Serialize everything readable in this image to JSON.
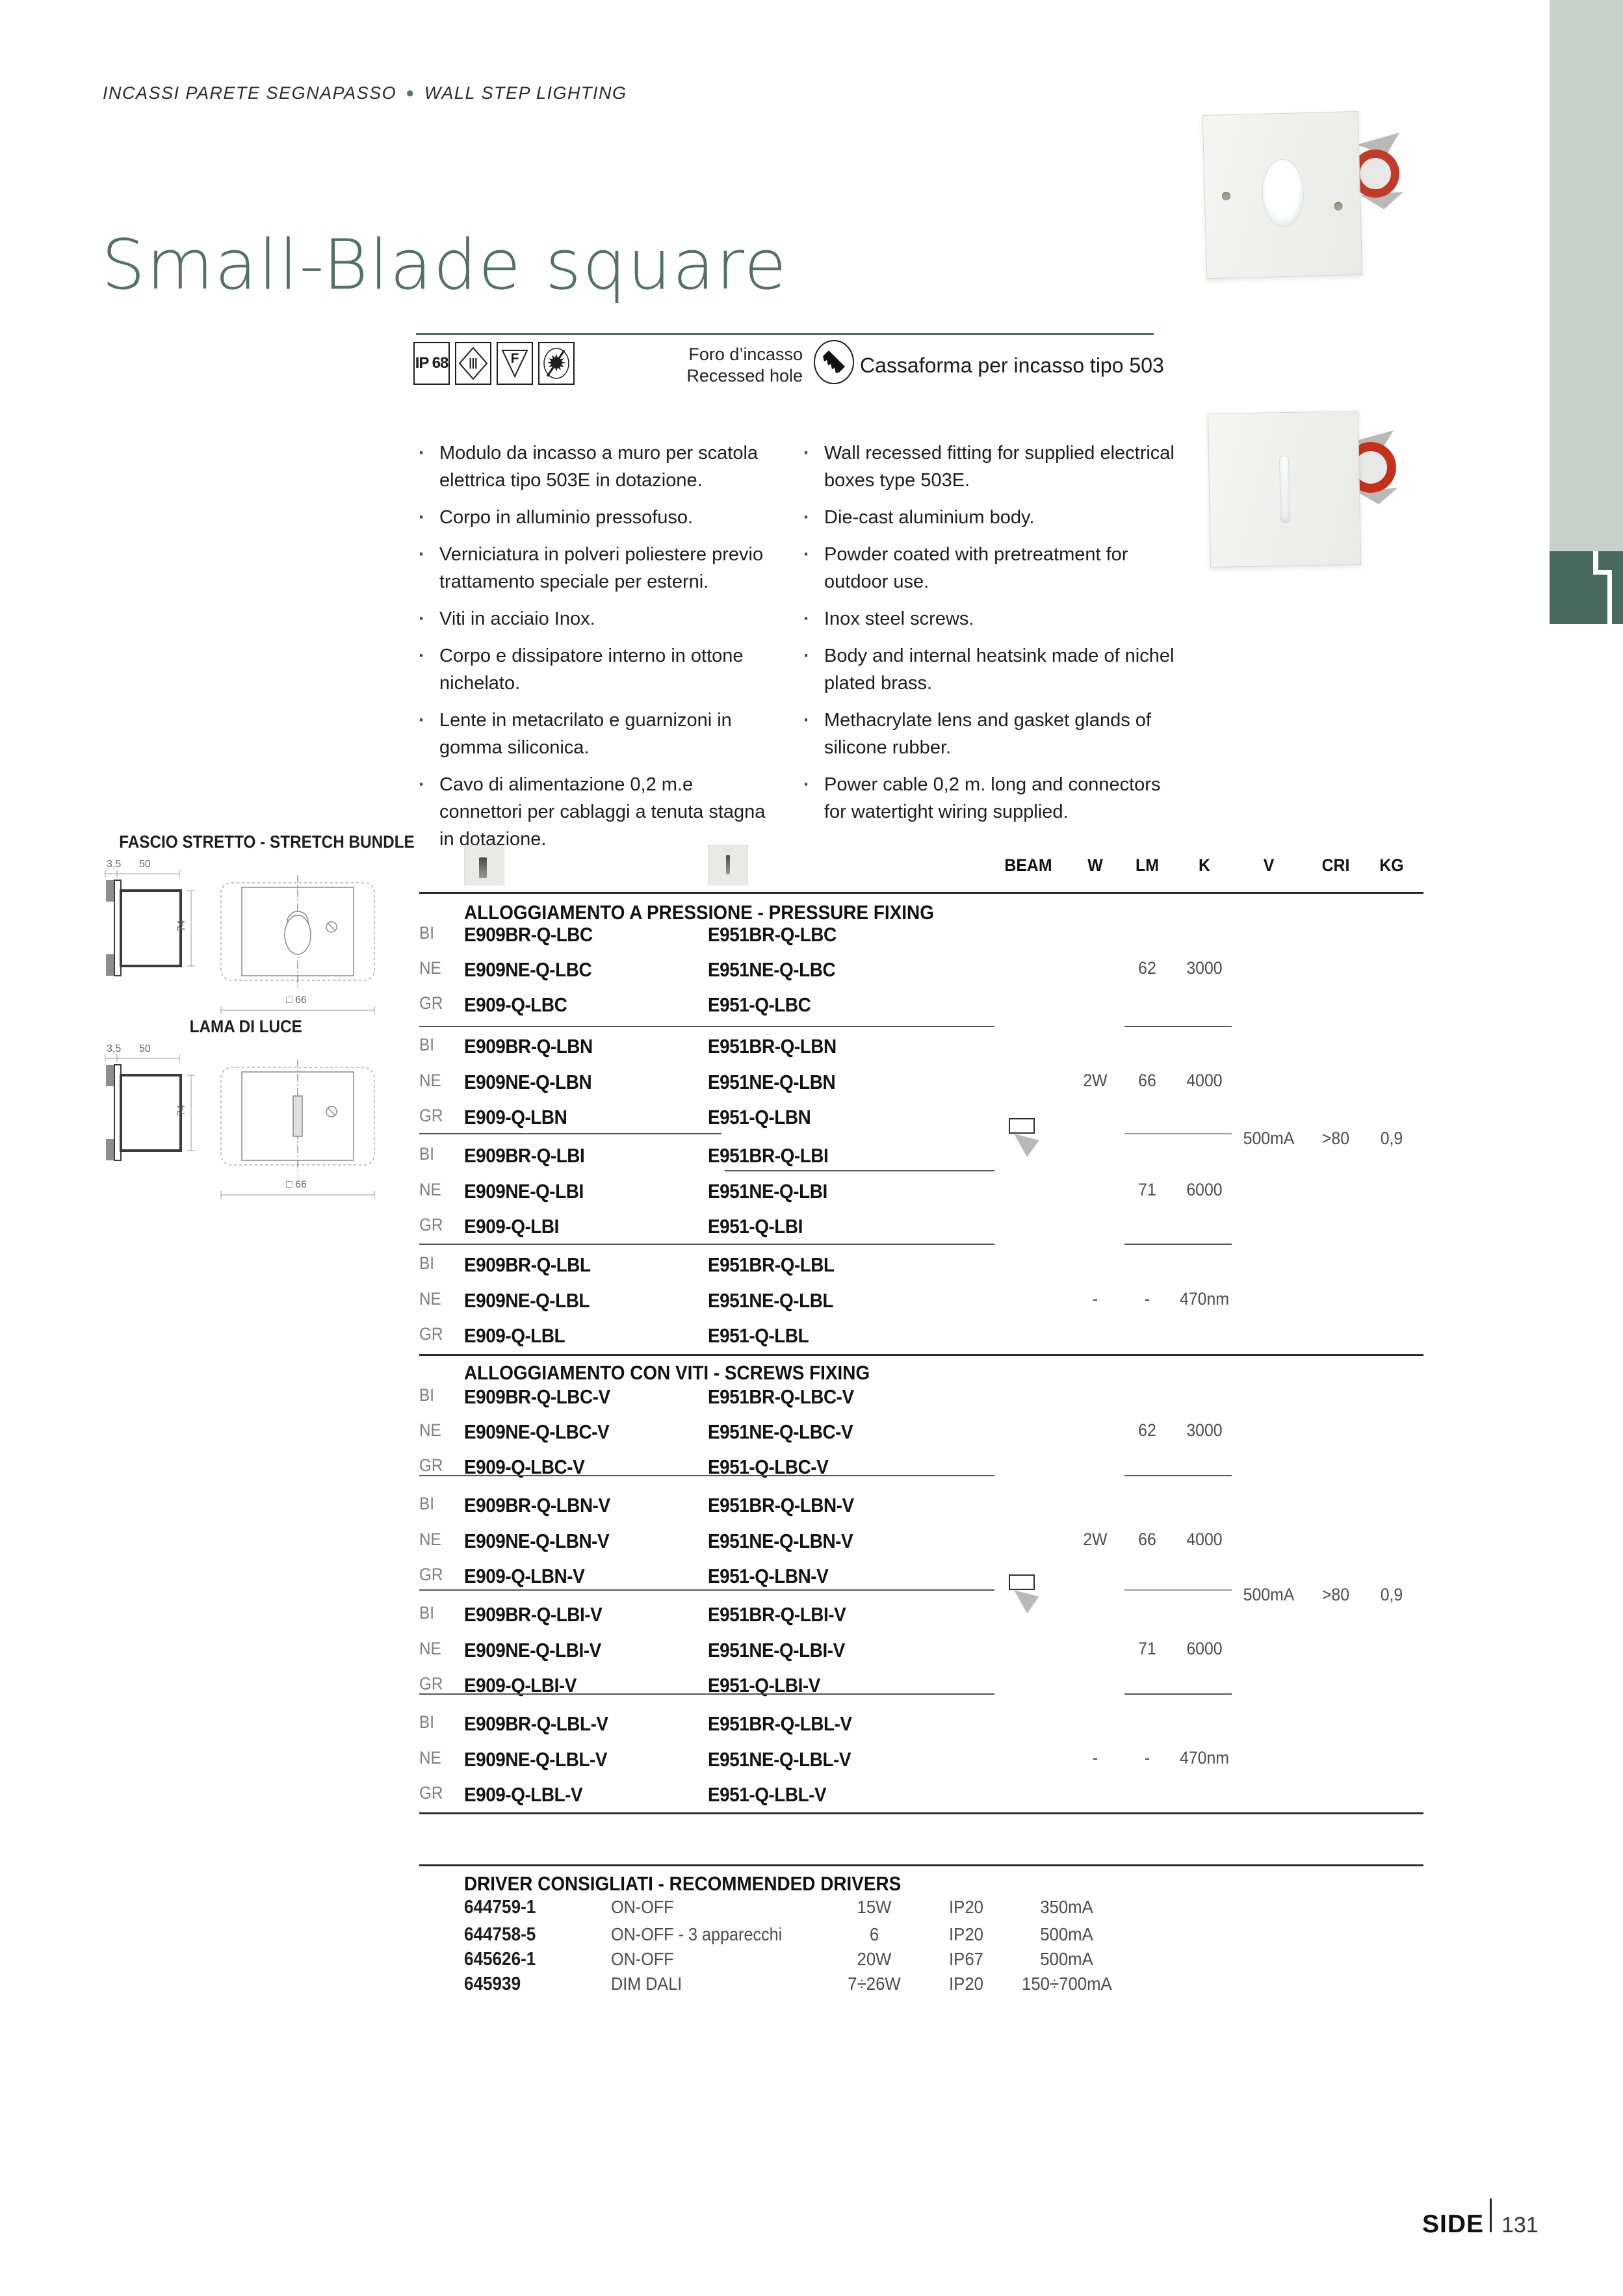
{
  "header": {
    "it": "INCASSI PARETE SEGNAPASSO",
    "sep": "●",
    "en": "WALL STEP LIGHTING"
  },
  "title": "Small-Blade square",
  "badges": {
    "ip": "IP 68",
    "class3": "Ⅲ",
    "f": "F",
    "sun": "✹"
  },
  "recess": {
    "it": "Foro d’incasso",
    "en": "Recessed hole",
    "label": "Cassaforma per incasso tipo 503"
  },
  "features": {
    "it": [
      "Modulo da incasso a muro per scatola elettrica tipo 503E in dotazione.",
      "Corpo in alluminio pressofuso.",
      "Verniciatura in polveri poliestere previo trattamento speciale per esterni.",
      "Viti in acciaio Inox.",
      "Corpo e dissipatore interno in ottone nichelato.",
      "Lente in metacrilato e guarnizoni in gomma siliconica.",
      "Cavo di alimentazione 0,2 m.e connettori per cablaggi a tenuta stagna in dotazione."
    ],
    "en": [
      "Wall recessed fitting for supplied electrical boxes type 503E.",
      "Die-cast aluminium body.",
      "Powder coated with pretreatment for outdoor use.",
      "Inox steel screws.",
      "Body and internal heatsink made of nichel plated brass.",
      "Methacrylate lens and gasket glands of silicone rubber.",
      "Power cable 0,2 m. long and connectors for watertight wiring supplied."
    ]
  },
  "drawings": {
    "t1": "FASCIO STRETTO - STRETCH BUNDLE",
    "t2": "LAMA DI LUCE",
    "d35": "3,5",
    "d50": "50",
    "d74": "74",
    "d66": "□ 66"
  },
  "table": {
    "cols": [
      "BEAM",
      "W",
      "LM",
      "K",
      "V",
      "CRI",
      "KG"
    ],
    "shared": {
      "v": "500mA",
      "cri": ">80",
      "kg": "0,9"
    },
    "s1": {
      "title": "ALLOGGIAMENTO A PRESSIONE - PRESSURE FIXING",
      "g": [
        {
          "rows": [
            {
              "f": "BI",
              "a": "E909BR-Q-LBC",
              "b": "E951BR-Q-LBC"
            },
            {
              "f": "NE",
              "a": "E909NE-Q-LBC",
              "b": "E951NE-Q-LBC"
            },
            {
              "f": "GR",
              "a": "E909-Q-LBC",
              "b": "E951-Q-LBC"
            }
          ],
          "lm": "62",
          "k": "3000"
        },
        {
          "rows": [
            {
              "f": "BI",
              "a": "E909BR-Q-LBN",
              "b": "E951BR-Q-LBN"
            },
            {
              "f": "NE",
              "a": "E909NE-Q-LBN",
              "b": "E951NE-Q-LBN"
            },
            {
              "f": "GR",
              "a": "E909-Q-LBN",
              "b": "E951-Q-LBN"
            }
          ],
          "w": "2W",
          "lm": "66",
          "k": "4000"
        },
        {
          "rows": [
            {
              "f": "BI",
              "a": "E909BR-Q-LBI",
              "b": "E951BR-Q-LBI"
            },
            {
              "f": "NE",
              "a": "E909NE-Q-LBI",
              "b": "E951NE-Q-LBI"
            },
            {
              "f": "GR",
              "a": "E909-Q-LBI",
              "b": "E951-Q-LBI"
            }
          ],
          "lm": "71",
          "k": "6000"
        },
        {
          "rows": [
            {
              "f": "BI",
              "a": "E909BR-Q-LBL",
              "b": "E951BR-Q-LBL"
            },
            {
              "f": "NE",
              "a": "E909NE-Q-LBL",
              "b": "E951NE-Q-LBL"
            },
            {
              "f": "GR",
              "a": "E909-Q-LBL",
              "b": "E951-Q-LBL"
            }
          ],
          "w": "-",
          "lm": "-",
          "k": "470nm"
        }
      ]
    },
    "s2": {
      "title": "ALLOGGIAMENTO CON VITI - SCREWS FIXING",
      "g": [
        {
          "rows": [
            {
              "f": "BI",
              "a": "E909BR-Q-LBC-V",
              "b": "E951BR-Q-LBC-V"
            },
            {
              "f": "NE",
              "a": "E909NE-Q-LBC-V",
              "b": "E951NE-Q-LBC-V"
            },
            {
              "f": "GR",
              "a": "E909-Q-LBC-V",
              "b": "E951-Q-LBC-V"
            }
          ],
          "lm": "62",
          "k": "3000"
        },
        {
          "rows": [
            {
              "f": "BI",
              "a": "E909BR-Q-LBN-V",
              "b": "E951BR-Q-LBN-V"
            },
            {
              "f": "NE",
              "a": "E909NE-Q-LBN-V",
              "b": "E951NE-Q-LBN-V"
            },
            {
              "f": "GR",
              "a": "E909-Q-LBN-V",
              "b": "E951-Q-LBN-V"
            }
          ],
          "w": "2W",
          "lm": "66",
          "k": "4000"
        },
        {
          "rows": [
            {
              "f": "BI",
              "a": "E909BR-Q-LBI-V",
              "b": "E951BR-Q-LBI-V"
            },
            {
              "f": "NE",
              "a": "E909NE-Q-LBI-V",
              "b": "E951NE-Q-LBI-V"
            },
            {
              "f": "GR",
              "a": "E909-Q-LBI-V",
              "b": "E951-Q-LBI-V"
            }
          ],
          "lm": "71",
          "k": "6000"
        },
        {
          "rows": [
            {
              "f": "BI",
              "a": "E909BR-Q-LBL-V",
              "b": "E951BR-Q-LBL-V"
            },
            {
              "f": "NE",
              "a": "E909NE-Q-LBL-V",
              "b": "E951NE-Q-LBL-V"
            },
            {
              "f": "GR",
              "a": "E909-Q-LBL-V",
              "b": "E951-Q-LBL-V"
            }
          ],
          "w": "-",
          "lm": "-",
          "k": "470nm"
        }
      ]
    }
  },
  "drivers": {
    "title": "DRIVER CONSIGLIATI - RECOMMENDED DRIVERS",
    "rows": [
      {
        "code": "644759-1",
        "type": "ON-OFF",
        "w": "15W",
        "ip": "IP20",
        "ma": "350mA"
      },
      {
        "code": "644758-5",
        "type": "ON-OFF - 3 apparecchi",
        "w": "6",
        "ip": "IP20",
        "ma": "500mA"
      },
      {
        "code": "645626-1",
        "type": "ON-OFF",
        "w": "20W",
        "ip": "IP67",
        "ma": "500mA"
      },
      {
        "code": "645939",
        "type": "DIM DALI",
        "w": "7÷26W",
        "ip": "IP20",
        "ma": "150÷700mA"
      }
    ]
  },
  "footer": {
    "brand": "SIDE",
    "page": "131"
  },
  "colors": {
    "teal": "#3e695c",
    "title": "#527065",
    "sage_band": "#c7d0ca",
    "logo_green": "#47695e",
    "lens_red": "#c23b28"
  }
}
